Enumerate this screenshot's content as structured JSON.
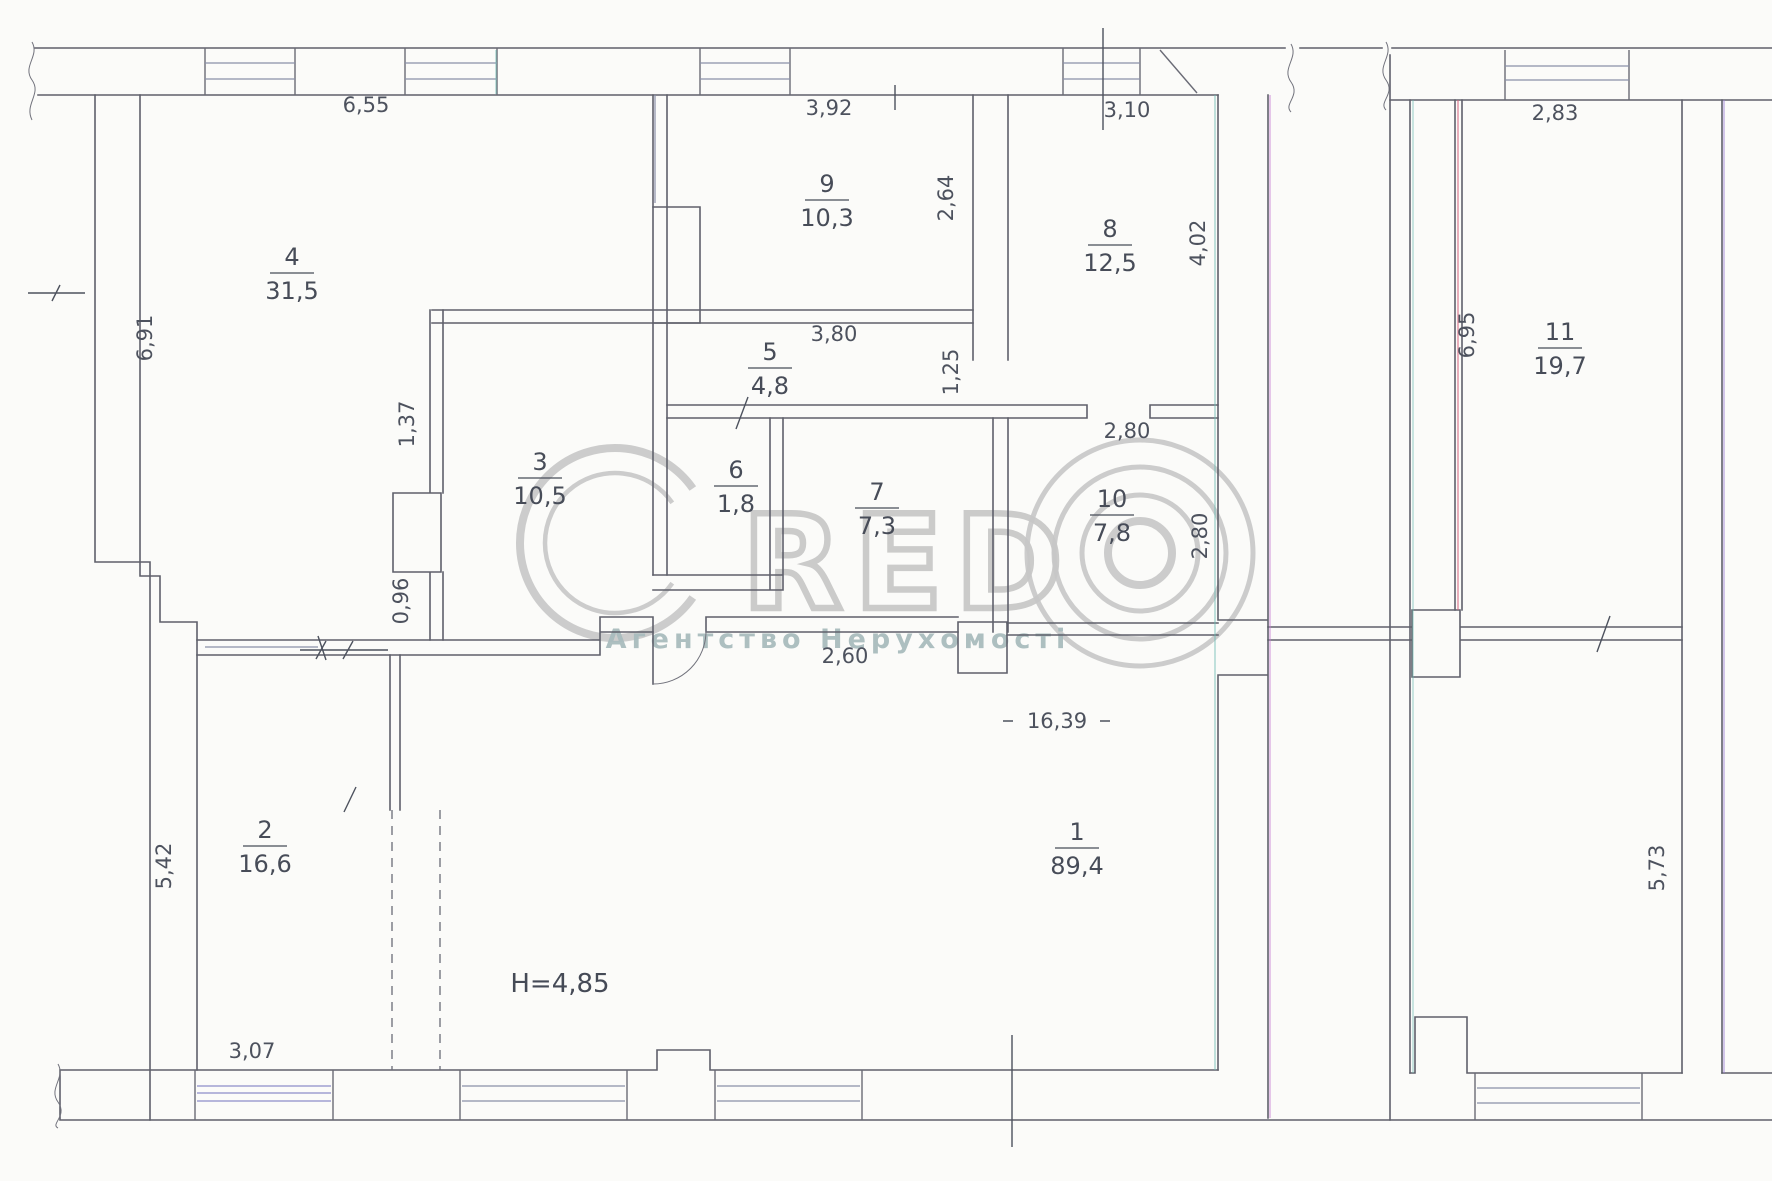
{
  "rooms": [
    {
      "number": "1",
      "area": "89,4"
    },
    {
      "number": "2",
      "area": "16,6"
    },
    {
      "number": "3",
      "area": "10,5"
    },
    {
      "number": "4",
      "area": "31,5"
    },
    {
      "number": "5",
      "area": "4,8"
    },
    {
      "number": "6",
      "area": "1,8"
    },
    {
      "number": "7",
      "area": "7,3"
    },
    {
      "number": "8",
      "area": "12,5"
    },
    {
      "number": "9",
      "area": "10,3"
    },
    {
      "number": "10",
      "area": "7,8"
    },
    {
      "number": "11",
      "area": "19,7"
    }
  ],
  "dimensions": {
    "room4_width": "6,55",
    "room9_width": "3,92",
    "room8_width": "3,10",
    "room11_width": "2,83",
    "room4_height": "6,91",
    "wall_seg_upper": "1,37",
    "wall_seg_lower": "0,96",
    "room2_height": "5,42",
    "room9_height": "2,64",
    "room8_height": "4,02",
    "corridor_width": "1,25",
    "room9_width_bottom": "3,80",
    "room10_width": "2,80",
    "room10_height": "2,80",
    "corridor7_width": "2,60",
    "room1_width": "16,39",
    "room2_width": "3,07",
    "room11_height": "6,95",
    "right_lower_height": "5,73"
  },
  "notes": {
    "ceiling_height": "H=4,85"
  },
  "watermark": {
    "brand_name": "CREDO",
    "brand_letters": "RED",
    "subtitle": "Агентство Нерухомості"
  }
}
